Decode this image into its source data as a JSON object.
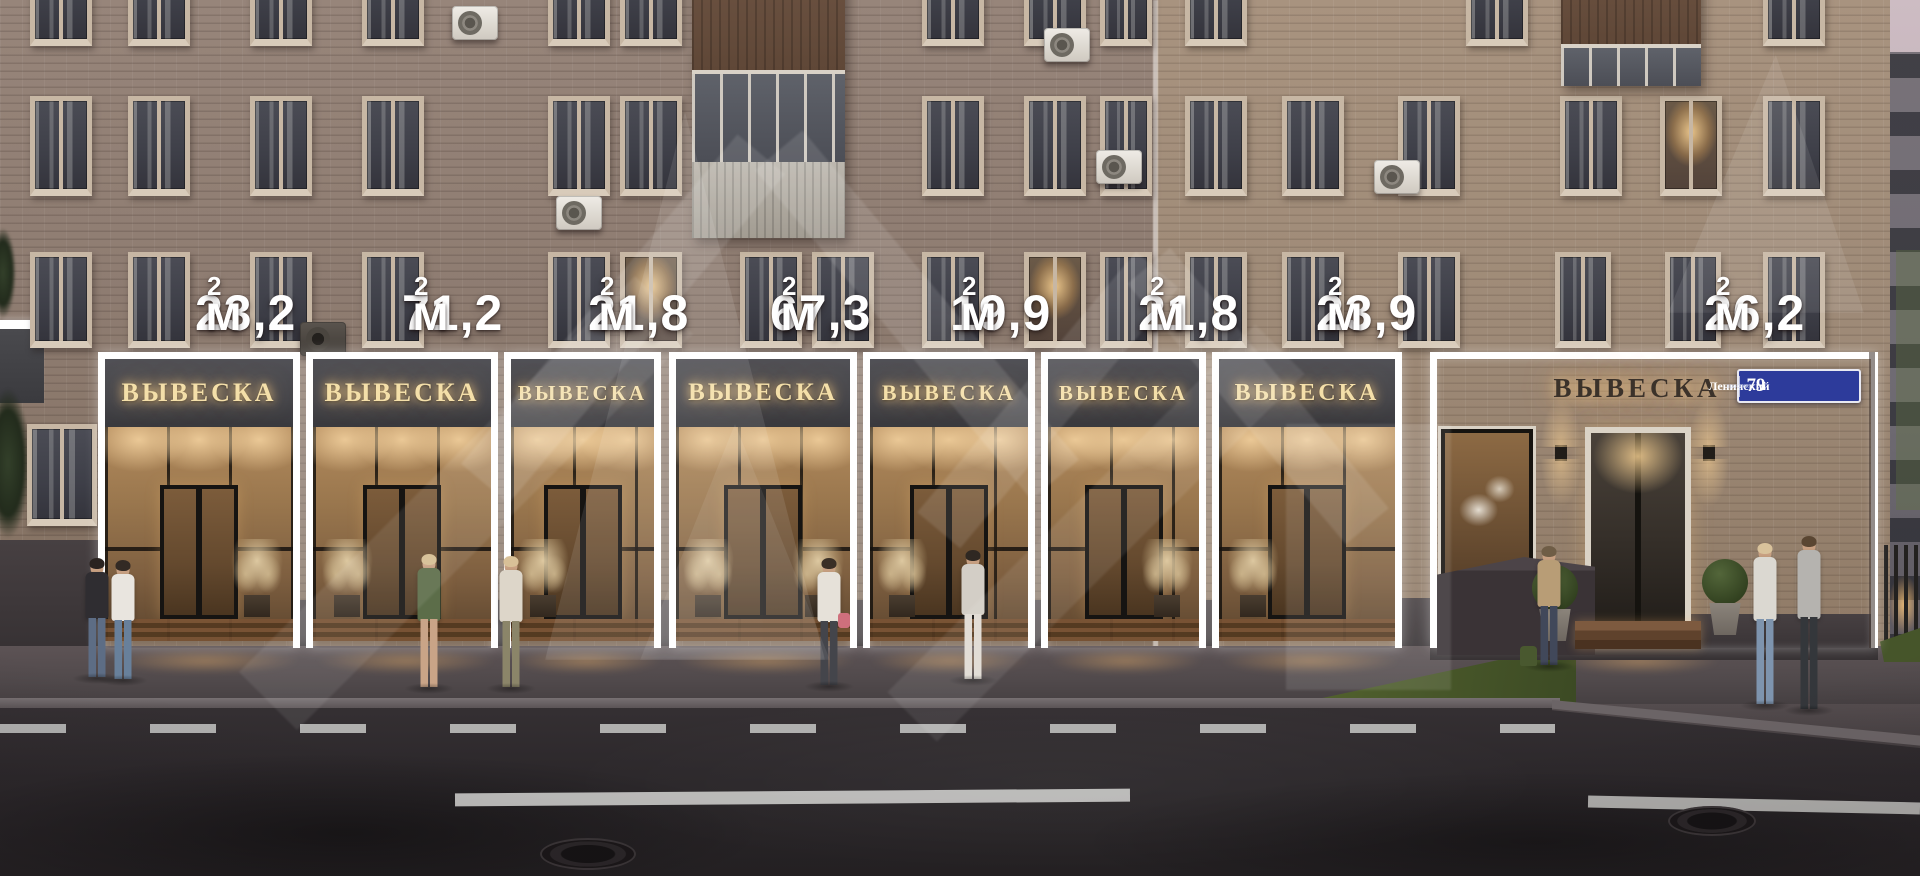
{
  "units": [
    {
      "area": "23,2",
      "sign": "ВЫВЕСКА"
    },
    {
      "area": "71,2",
      "sign": "ВЫВЕСКА"
    },
    {
      "area": "21,8",
      "sign": "ВЫВЕСКА"
    },
    {
      "area": "67,3",
      "sign": "ВЫВЕСКА"
    },
    {
      "area": "19,9",
      "sign": "ВЫВЕСКА"
    },
    {
      "area": "21,8",
      "sign": "ВЫВЕСКА"
    },
    {
      "area": "23,9",
      "sign": "ВЫВЕСКА"
    },
    {
      "area": "26,2",
      "sign": "ВЫВЕСКА"
    }
  ],
  "area_unit": {
    "letter": "м",
    "superscript": "2"
  },
  "address_plate": {
    "street": "Ленинский",
    "street_type": "проспект",
    "number": "79"
  },
  "watermark": {
    "icon": "house-chevron-logo-watermark"
  },
  "colors": {
    "label_text": "#ffffff",
    "overlay_frame": "#ffffff",
    "fascia": "#45454a",
    "sign_glow": "#f4dfa9",
    "sign_dark": "#3b322a",
    "address_plate_bg": "#2d3b9b",
    "brick_main": "#8e7c71",
    "brick_right": "#9e8a77",
    "interior_warm": "#9a774e",
    "asphalt": "#2c282b",
    "sidewalk": "#514a4c",
    "grass": "#4a5a2c"
  },
  "scene": {
    "windows": [
      {
        "x": 30,
        "y": -54,
        "w": 62,
        "h": 100
      },
      {
        "x": 128,
        "y": -54,
        "w": 62,
        "h": 100
      },
      {
        "x": 250,
        "y": -54,
        "w": 62,
        "h": 100
      },
      {
        "x": 362,
        "y": -54,
        "w": 62,
        "h": 100
      },
      {
        "x": 548,
        "y": -54,
        "w": 62,
        "h": 100
      },
      {
        "x": 620,
        "y": -54,
        "w": 62,
        "h": 100
      },
      {
        "x": 922,
        "y": -54,
        "w": 62,
        "h": 100
      },
      {
        "x": 1024,
        "y": -54,
        "w": 62,
        "h": 100
      },
      {
        "x": 1100,
        "y": -54,
        "w": 52,
        "h": 100
      },
      {
        "x": 1185,
        "y": -54,
        "w": 62,
        "h": 100
      },
      {
        "x": 1466,
        "y": -54,
        "w": 62,
        "h": 100
      },
      {
        "x": 1763,
        "y": -54,
        "w": 62,
        "h": 100
      },
      {
        "x": 30,
        "y": 96,
        "w": 62,
        "h": 100
      },
      {
        "x": 128,
        "y": 96,
        "w": 62,
        "h": 100
      },
      {
        "x": 250,
        "y": 96,
        "w": 62,
        "h": 100
      },
      {
        "x": 362,
        "y": 96,
        "w": 62,
        "h": 100
      },
      {
        "x": 548,
        "y": 96,
        "w": 62,
        "h": 100
      },
      {
        "x": 620,
        "y": 96,
        "w": 62,
        "h": 100
      },
      {
        "x": 922,
        "y": 96,
        "w": 62,
        "h": 100
      },
      {
        "x": 1024,
        "y": 96,
        "w": 62,
        "h": 100
      },
      {
        "x": 1100,
        "y": 96,
        "w": 52,
        "h": 100
      },
      {
        "x": 1185,
        "y": 96,
        "w": 62,
        "h": 100
      },
      {
        "x": 1282,
        "y": 96,
        "w": 62,
        "h": 100
      },
      {
        "x": 1398,
        "y": 96,
        "w": 62,
        "h": 100
      },
      {
        "x": 1560,
        "y": 96,
        "w": 62,
        "h": 100
      },
      {
        "x": 1660,
        "y": 96,
        "w": 62,
        "h": 100,
        "lit": true
      },
      {
        "x": 1763,
        "y": 96,
        "w": 62,
        "h": 100
      },
      {
        "x": 30,
        "y": 252,
        "w": 62,
        "h": 96
      },
      {
        "x": 128,
        "y": 252,
        "w": 62,
        "h": 96
      },
      {
        "x": 250,
        "y": 252,
        "w": 62,
        "h": 96
      },
      {
        "x": 362,
        "y": 252,
        "w": 62,
        "h": 96
      },
      {
        "x": 548,
        "y": 252,
        "w": 62,
        "h": 96
      },
      {
        "x": 620,
        "y": 252,
        "w": 62,
        "h": 96,
        "lit": true
      },
      {
        "x": 740,
        "y": 252,
        "w": 62,
        "h": 96
      },
      {
        "x": 812,
        "y": 252,
        "w": 62,
        "h": 96
      },
      {
        "x": 922,
        "y": 252,
        "w": 62,
        "h": 96
      },
      {
        "x": 1024,
        "y": 252,
        "w": 62,
        "h": 96,
        "lit": true
      },
      {
        "x": 1100,
        "y": 252,
        "w": 52,
        "h": 96
      },
      {
        "x": 1185,
        "y": 252,
        "w": 62,
        "h": 96
      },
      {
        "x": 1282,
        "y": 252,
        "w": 62,
        "h": 96
      },
      {
        "x": 1398,
        "y": 252,
        "w": 62,
        "h": 96
      },
      {
        "x": 1555,
        "y": 252,
        "w": 56,
        "h": 96
      },
      {
        "x": 1665,
        "y": 252,
        "w": 56,
        "h": 96
      },
      {
        "x": 1763,
        "y": 252,
        "w": 62,
        "h": 96
      },
      {
        "x": 27,
        "y": 424,
        "w": 70,
        "h": 102
      }
    ],
    "acs": [
      {
        "x": 452,
        "y": 6
      },
      {
        "x": 556,
        "y": 196
      },
      {
        "x": 300,
        "y": 322,
        "dark": true
      },
      {
        "x": 1044,
        "y": 28
      },
      {
        "x": 1096,
        "y": 150
      },
      {
        "x": 1374,
        "y": 160
      }
    ],
    "people": [
      {
        "x": 80,
        "y": 560,
        "h": 118,
        "top": "#2f2d31",
        "bot": "#5d6d85",
        "hair": "#2a2320"
      },
      {
        "x": 106,
        "y": 562,
        "h": 118,
        "top": "#e9e5df",
        "bot": "#68809b",
        "hair": "#332a24"
      },
      {
        "x": 412,
        "y": 556,
        "h": 132,
        "top": "#5c6d49",
        "bot": "#c9a487",
        "hair": "#d5bd92"
      },
      {
        "x": 494,
        "y": 558,
        "h": 130,
        "top": "#ddd6c9",
        "bot": "#8b8569",
        "hair": "#d8c097"
      },
      {
        "x": 812,
        "y": 560,
        "h": 126,
        "top": "#e6e1d9",
        "bot": "#44454b",
        "hair": "#3a2f26",
        "bag": "#cf6f7c"
      },
      {
        "x": 956,
        "y": 552,
        "h": 128,
        "top": "#d3cec6",
        "bot": "#e0dbd3",
        "hair": "#2f2822"
      },
      {
        "x": 1532,
        "y": 548,
        "h": 118,
        "top": "#b89d76",
        "bot": "#41485a",
        "hair": "#6f5d46",
        "bag": "#49582f",
        "bagpos": "feet"
      },
      {
        "x": 1748,
        "y": 545,
        "h": 160,
        "top": "#dbd8d1",
        "bot": "#7e94ae",
        "hair": "#d9c29b"
      },
      {
        "x": 1792,
        "y": 538,
        "h": 172,
        "top": "#b5b3af",
        "bot": "#34373b",
        "hair": "#5a4632"
      }
    ]
  }
}
